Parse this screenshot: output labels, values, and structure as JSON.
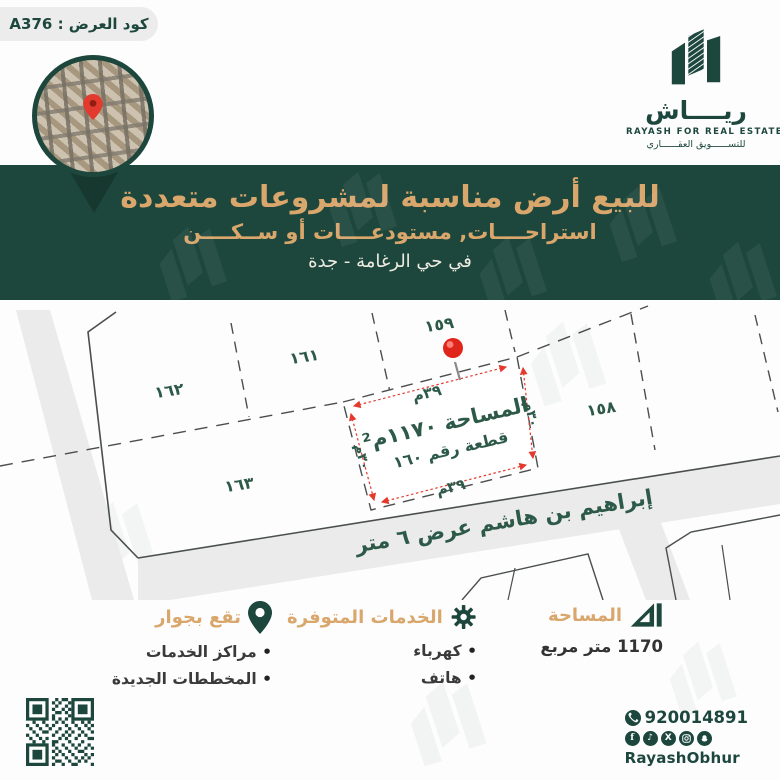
{
  "badge": {
    "offer_code": "كود العرض : A376"
  },
  "logo": {
    "brand_arabic": "ريــــاش",
    "brand_english": "RAYASH FOR REAL ESTATE",
    "tagline": "للتســــــويق العقــــــاري"
  },
  "banner": {
    "title": "للبيع أرض مناسبة لمشروعات متعددة",
    "subtitle": "استراحــــات, مستودعــــات أو ســكــــن",
    "location": "في حي الرغامة - جدة"
  },
  "map": {
    "street_label": "إبراهيم بن هاشم عرض ٦ متر",
    "plot_158": "١٥٨",
    "plot_159": "١٥٩",
    "plot_161": "١٦١",
    "plot_162": "١٦٢",
    "plot_163": "١٦٣",
    "highlight": {
      "area": "المساحة ١١٧٠م²",
      "plot_no": "قطعة رقم ١٦٠",
      "width_top": "٣٩م",
      "width_bottom": "٣٩م",
      "depth_left": "٣٠م",
      "depth_right": "٣٠م"
    }
  },
  "details": {
    "area": {
      "title": "المساحة",
      "value": "1170 متر مربع"
    },
    "services": {
      "title": "الخدمات المتوفرة",
      "items": [
        "كهرباء",
        "هاتف"
      ]
    },
    "nearby": {
      "title": "تقع بجوار",
      "items": [
        "مراكز الخدمات",
        "المخططات الجديدة"
      ]
    }
  },
  "contact": {
    "phone": "920014891",
    "handle": "RayashObhur"
  },
  "colors": {
    "dark_green": "#1d473d",
    "gold": "#d9a66c",
    "label_green": "#2d5948",
    "red": "#e4392c",
    "road_gray": "#ebebeb"
  }
}
